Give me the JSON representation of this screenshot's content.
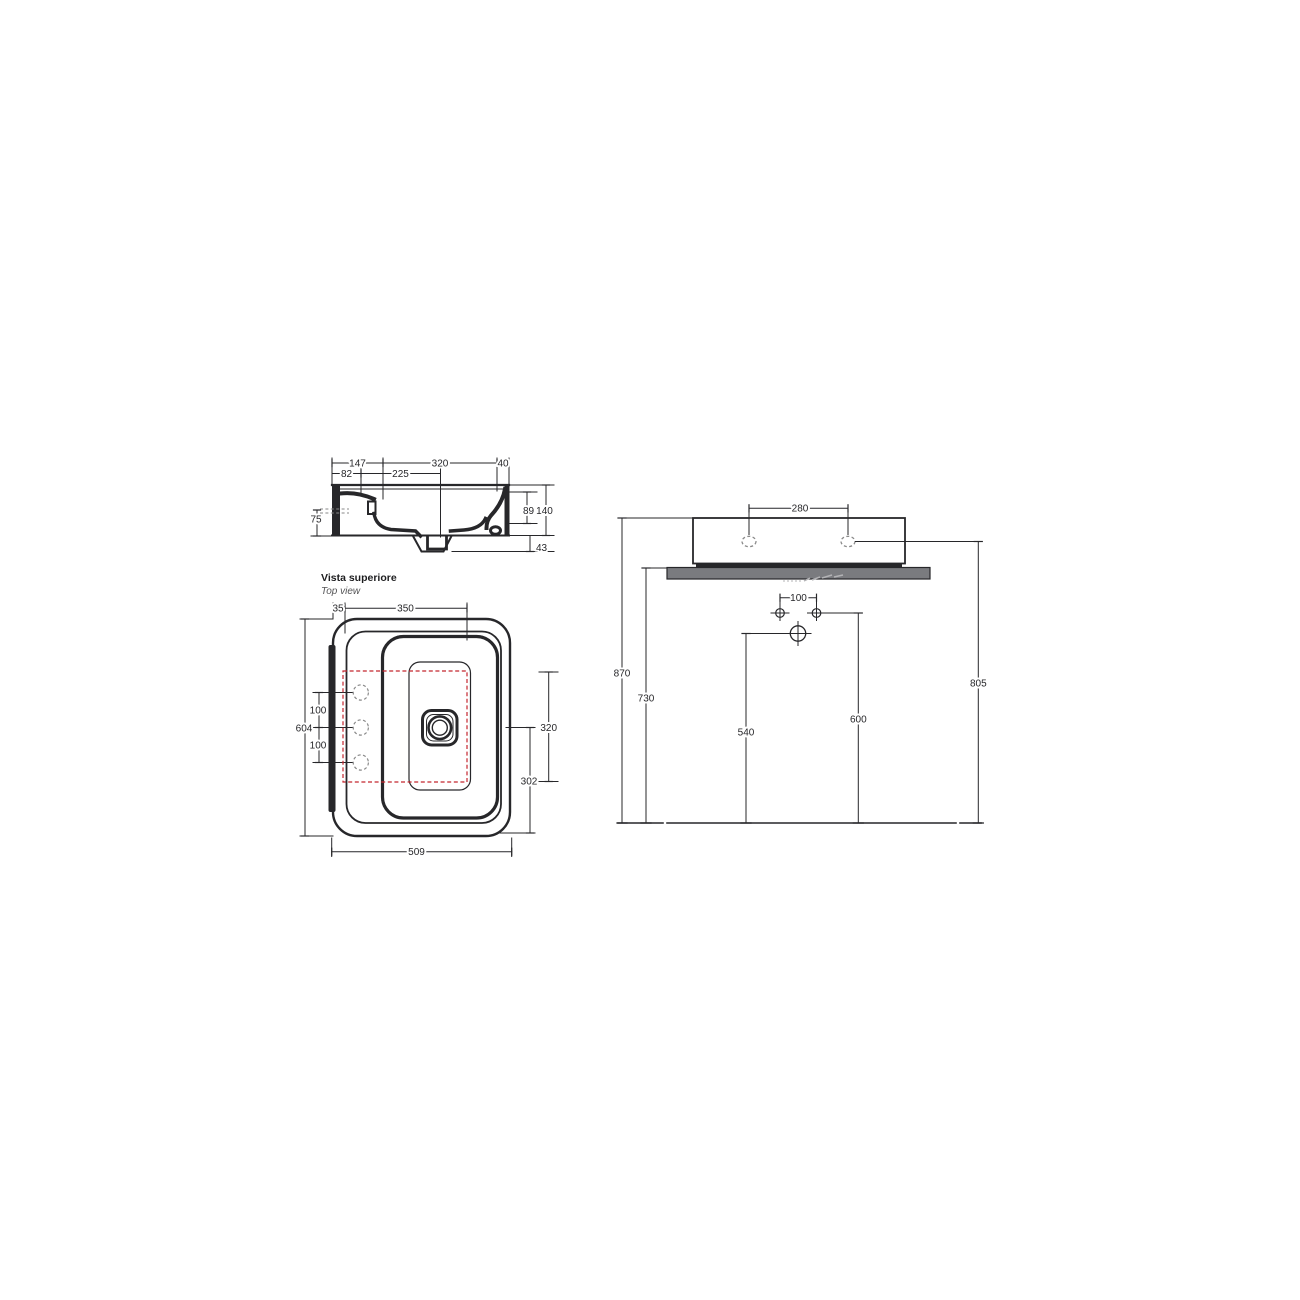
{
  "colors": {
    "bg": "#ffffff",
    "line": "#27272a",
    "counter": "#7a7b7f",
    "red": "#c4262e",
    "dash": "#8a8a8a"
  },
  "section": {
    "d147": "147",
    "d320": "320",
    "d40": "40",
    "d82": "82",
    "d225": "225",
    "d75": "75",
    "d89": "89",
    "d140": "140",
    "d43": "43"
  },
  "top": {
    "title_it": "Vista superiore",
    "title_en": "Top view",
    "d35": "35",
    "d350": "350",
    "d100a": "100",
    "d604": "604",
    "d100b": "100",
    "d320": "320",
    "d302": "302",
    "d509": "509"
  },
  "front": {
    "d280": "280",
    "d100": "100",
    "d870": "870",
    "d730": "730",
    "d540": "540",
    "d600": "600",
    "d805": "805"
  }
}
